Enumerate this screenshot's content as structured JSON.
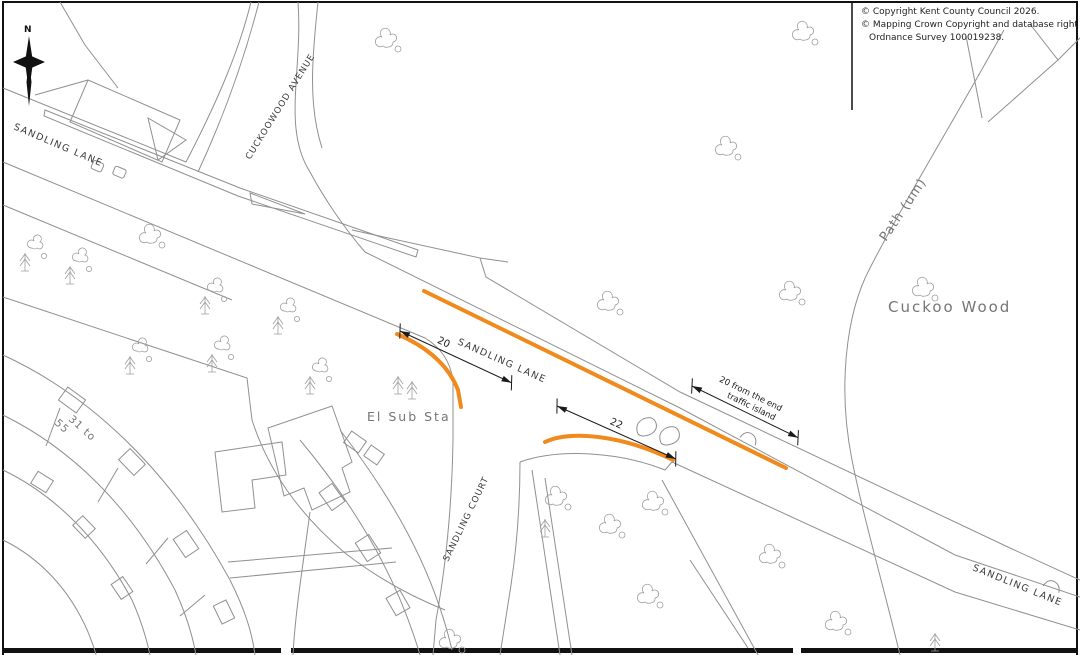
{
  "copyright": {
    "line1": "© Copyright Kent County Council 2026.",
    "line2": "© Mapping Crown Copyright and database right 2026.",
    "line3": "Ordnance Survey 100019238."
  },
  "north_arrow": {
    "label": "N"
  },
  "labels": {
    "sandling_lane_top_left": "SANDLING LANE",
    "cuckoowood_avenue": "CUCKOOWOOD AVENUE",
    "sandling_lane_center": "SANDLING LANE",
    "sandling_court": "SANDLING COURT",
    "sandling_lane_bottom_right": "SANDLING LANE",
    "path_um": "Path (um)",
    "cuckoo_wood": "Cuckoo Wood",
    "el_sub_sta": "El Sub Sta",
    "houses_range_line1": "31 to",
    "houses_range_line2": "55"
  },
  "dimensions": {
    "d1": "20",
    "d2": "22",
    "d3_line1": "20 from the end",
    "d3_line2": "traffic island"
  },
  "colors": {
    "highlight_orange": "#F08A1D",
    "map_line_gray": "#909090",
    "os_label_gray": "#757575",
    "dimension_black": "#1a1a1a"
  }
}
